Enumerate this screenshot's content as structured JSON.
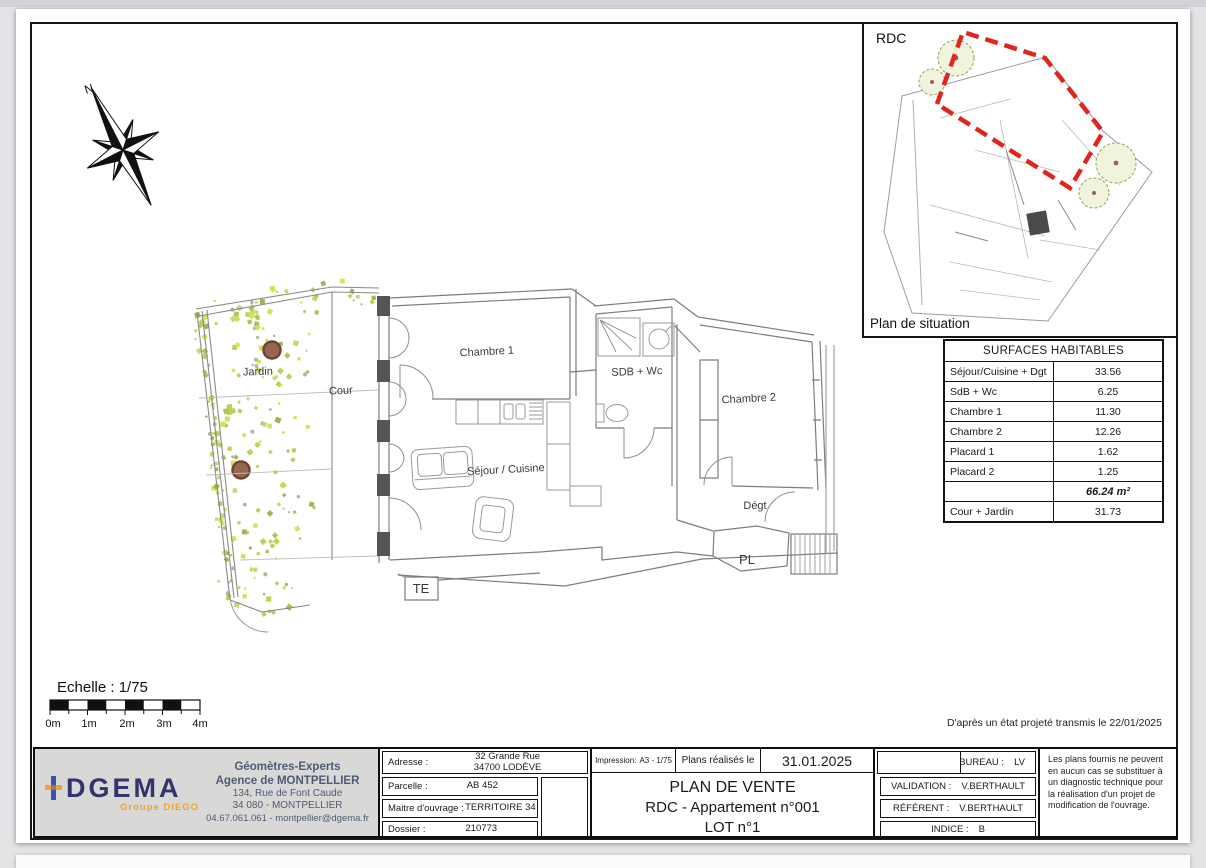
{
  "colors": {
    "accent_red": "#e0251f",
    "brand_navy": "#33336e",
    "brand_orange": "#f0a235",
    "trunk_brown": "#96664e",
    "foliage_palette": [
      "#d8e141",
      "#cfdb4a",
      "#bccd3f",
      "#a8bf45",
      "#93ad3f",
      "#c2d46a",
      "#b7c94f"
    ],
    "speck_gray": "#a9b18a"
  },
  "compass": {
    "north_label": "N"
  },
  "situation": {
    "floor": "RDC",
    "caption": "Plan de situation"
  },
  "floor_plan": {
    "labels": {
      "jardin": "Jardin",
      "cour": "Cour",
      "chambre1": "Chambre 1",
      "sdb": "SDB + Wc",
      "chambre2": "Chambre 2",
      "sejour": "Séjour / Cuisine",
      "degt": "Dégt",
      "pl": "PL",
      "te": "TE"
    }
  },
  "scale": {
    "label": "Echelle : 1/75",
    "ticks": [
      "0m",
      "1m",
      "2m",
      "3m",
      "4m"
    ]
  },
  "note_bottom_right": "D'après un état projeté transmis le 22/01/2025",
  "surfaces_table": {
    "title": "SURFACES HABITABLES",
    "rows": [
      {
        "label": "Séjour/Cuisine + Dgt",
        "value": "33.56"
      },
      {
        "label": "SdB + Wc",
        "value": "6.25"
      },
      {
        "label": "Chambre 1",
        "value": "11.30"
      },
      {
        "label": "Chambre 2",
        "value": "12.26"
      },
      {
        "label": "Placard 1",
        "value": "1.62"
      },
      {
        "label": "Placard 2",
        "value": "1.25"
      },
      {
        "label": "",
        "value": "66.24 m²"
      },
      {
        "label": "Cour + Jardin",
        "value": "31.73"
      }
    ]
  },
  "title_block": {
    "company": {
      "name": "DGEMA",
      "group": "Groupe DIEGO",
      "line1": "Géomètres-Experts",
      "line2": "Agence de MONTPELLIER",
      "line3": "134, Rue de Font Caude",
      "line4": "34 080 - MONTPELLIER",
      "line5": "04.67.061.061 - montpellier@dgema.fr"
    },
    "fields": {
      "adresse_label": "Adresse :",
      "adresse_value1": "32 Grande Rue",
      "adresse_value2": "34700 LODÈVE",
      "parcelle_label": "Parcelle :",
      "parcelle_value": "AB 452",
      "moa_label": "Maitre d'ouvrage :",
      "moa_value": "TERRITOIRE 34",
      "dossier_label": "Dossier :",
      "dossier_value": "210773"
    },
    "print": {
      "impression_label": "Impression:",
      "impression_value": "A3 - 1/75",
      "plans_le": "Plans réalisés le",
      "date": "31.01.2025"
    },
    "title": {
      "line1": "PLAN DE VENTE",
      "line2": "RDC - Appartement n°001",
      "line3": "LOT n°1"
    },
    "people": {
      "bureau_label": "BUREAU :",
      "bureau": "LV",
      "validation_label": "VALIDATION :",
      "validation": "V.BERTHAULT",
      "referent_label": "RÉFÉRENT :",
      "referent": "V.BERTHAULT",
      "indice_label": "INDICE :",
      "indice": "B"
    },
    "disclaimer": "Les plans fournis ne peuvent en aucun cas se substituer à un diagnostic technique pour la réalisation d'un projet de modification de l'ouvrage."
  }
}
